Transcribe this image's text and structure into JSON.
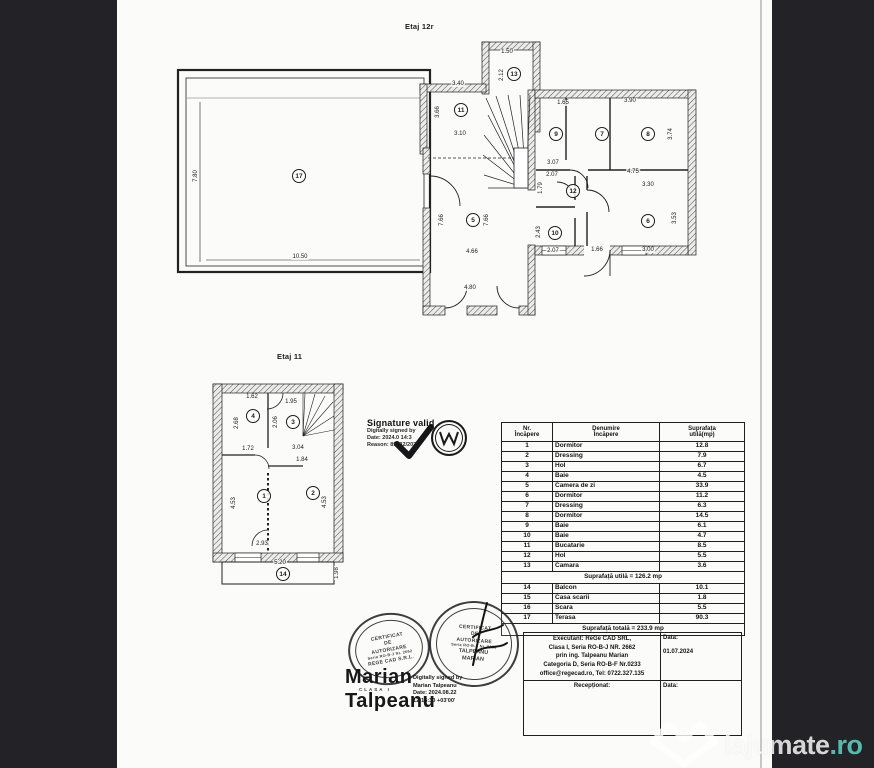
{
  "page": {
    "title_top": "Etaj 12r",
    "title_bottom": "Etaj 11"
  },
  "signature": {
    "line1": "Signature valid",
    "line2": "Digitally signed by",
    "line3": "Date: 2024.0 14:3",
    "line4": "Reason: 89632/2024"
  },
  "room_table": {
    "headers": [
      "Nr.\nÎncăpere",
      "Denumire\nÎncăpere",
      "Suprafața\nutilă(mp)"
    ],
    "rows": [
      [
        "1",
        "Dormitor",
        "12.8"
      ],
      [
        "2",
        "Dressing",
        "7.9"
      ],
      [
        "3",
        "Hol",
        "6.7"
      ],
      [
        "4",
        "Baie",
        "4.5"
      ],
      [
        "5",
        "Camera de zi",
        "33.9"
      ],
      [
        "6",
        "Dormitor",
        "11.2"
      ],
      [
        "7",
        "Dressing",
        "6.3"
      ],
      [
        "8",
        "Dormitor",
        "14.5"
      ],
      [
        "9",
        "Baie",
        "6.1"
      ],
      [
        "10",
        "Baie",
        "4.7"
      ],
      [
        "11",
        "Bucatarie",
        "8.5"
      ],
      [
        "12",
        "Hol",
        "5.5"
      ],
      [
        "13",
        "Camara",
        "3.6"
      ]
    ],
    "subtotal": "Suprafață utilă = 126.2 mp",
    "rows2": [
      [
        "14",
        "Balcon",
        "10.1"
      ],
      [
        "15",
        "Casa scarii",
        "1.8"
      ],
      [
        "16",
        "Scara",
        "5.5"
      ],
      [
        "17",
        "Terasa",
        "90.3"
      ]
    ],
    "total": "Suprafață totală = 233.9 mp"
  },
  "exec": {
    "lines": [
      "Executant: ReGe CAD SRL,",
      "Clasa I, Seria RO-B-J NR. 2662",
      "prin ing. Talpeanu Marian",
      "Categoria D, Seria RO-B-F Nr.0233",
      "office@regecad.ro, Tel: 0722.327.135"
    ],
    "data_label": "Data:",
    "data_value": "01.07.2024",
    "receptionat": "Recepționat:",
    "data_label2": "Data:"
  },
  "stamps": {
    "left": [
      "CERTIFICAT",
      "DE",
      "AUTORIZARE",
      "Seria RO-B-J Nr. 2662",
      "REGE CAD S.R.L."
    ],
    "right": [
      "CERTIFICAT",
      "DE",
      "AUTORIZARE",
      "Seria RO-B-F Nr. 0233",
      "TALPEANU",
      "MARIAN"
    ],
    "name_line1": "Marian",
    "name_sub": "CLASA I",
    "name_line2": "Talpeanu",
    "digital": [
      "Digitally signed by",
      "Marian Talpeanu",
      "Date: 2024.08.22",
      "12:16:30 +03'00'"
    ]
  },
  "watermark": {
    "brand": "lajumate",
    "tld": ".ro"
  },
  "plans": {
    "etaj12": {
      "rooms": [
        {
          "n": "17",
          "x": 129,
          "y": 136
        },
        {
          "n": "11",
          "x": 291,
          "y": 70
        },
        {
          "n": "13",
          "x": 344,
          "y": 34
        },
        {
          "n": "5",
          "x": 303,
          "y": 180
        },
        {
          "n": "9",
          "x": 386,
          "y": 94
        },
        {
          "n": "7",
          "x": 432,
          "y": 94
        },
        {
          "n": "8",
          "x": 478,
          "y": 94
        },
        {
          "n": "12",
          "x": 403,
          "y": 151
        },
        {
          "n": "10",
          "x": 385,
          "y": 193
        },
        {
          "n": "6",
          "x": 478,
          "y": 181
        }
      ],
      "dims": [
        {
          "t": "7.80",
          "x": 26,
          "y": 136,
          "v": 1
        },
        {
          "t": "10.50",
          "x": 130,
          "y": 217
        },
        {
          "t": "1.50",
          "x": 337,
          "y": 12
        },
        {
          "t": "2.12",
          "x": 332,
          "y": 35,
          "v": 1
        },
        {
          "t": "3.40",
          "x": 288,
          "y": 44
        },
        {
          "t": "3.66",
          "x": 268,
          "y": 72,
          "v": 1
        },
        {
          "t": "3.10",
          "x": 290,
          "y": 94
        },
        {
          "t": "7.66",
          "x": 272,
          "y": 180,
          "v": 1
        },
        {
          "t": "7.66",
          "x": 317,
          "y": 180,
          "v": 1
        },
        {
          "t": "4.66",
          "x": 302,
          "y": 212
        },
        {
          "t": "4.80",
          "x": 300,
          "y": 248
        },
        {
          "t": "1.65",
          "x": 393,
          "y": 63
        },
        {
          "t": "3.90",
          "x": 460,
          "y": 61
        },
        {
          "t": "3.74",
          "x": 501,
          "y": 94,
          "v": 1
        },
        {
          "t": "4.75",
          "x": 463,
          "y": 132
        },
        {
          "t": "3.30",
          "x": 478,
          "y": 145
        },
        {
          "t": "3.53",
          "x": 505,
          "y": 178,
          "v": 1
        },
        {
          "t": "3.07",
          "x": 383,
          "y": 123
        },
        {
          "t": "2.07",
          "x": 382,
          "y": 135
        },
        {
          "t": "1.79",
          "x": 371,
          "y": 148,
          "v": 1
        },
        {
          "t": "2.43",
          "x": 369,
          "y": 192,
          "v": 1
        },
        {
          "t": "2.07",
          "x": 383,
          "y": 211
        },
        {
          "t": "1.66",
          "x": 427,
          "y": 210
        },
        {
          "t": "3.00",
          "x": 478,
          "y": 210
        }
      ]
    },
    "etaj11": {
      "rooms": [
        {
          "n": "4",
          "x": 48,
          "y": 38
        },
        {
          "n": "3",
          "x": 88,
          "y": 44
        },
        {
          "n": "1",
          "x": 59,
          "y": 118
        },
        {
          "n": "2",
          "x": 108,
          "y": 115
        },
        {
          "n": "14",
          "x": 78,
          "y": 196
        }
      ],
      "dims": [
        {
          "t": "1.62",
          "x": 47,
          "y": 19
        },
        {
          "t": "1.95",
          "x": 86,
          "y": 24
        },
        {
          "t": "2.68",
          "x": 32,
          "y": 45,
          "v": 1
        },
        {
          "t": "2.06",
          "x": 71,
          "y": 44,
          "v": 1
        },
        {
          "t": "1.72",
          "x": 43,
          "y": 71
        },
        {
          "t": "3.04",
          "x": 93,
          "y": 70
        },
        {
          "t": "1.84",
          "x": 97,
          "y": 82
        },
        {
          "t": "4.53",
          "x": 29,
          "y": 125,
          "v": 1
        },
        {
          "t": "4.53",
          "x": 120,
          "y": 124,
          "v": 1
        },
        {
          "t": "2.93",
          "x": 57,
          "y": 166
        },
        {
          "t": "5.20",
          "x": 75,
          "y": 185
        },
        {
          "t": "1.98",
          "x": 132,
          "y": 195,
          "v": 1
        }
      ]
    }
  }
}
